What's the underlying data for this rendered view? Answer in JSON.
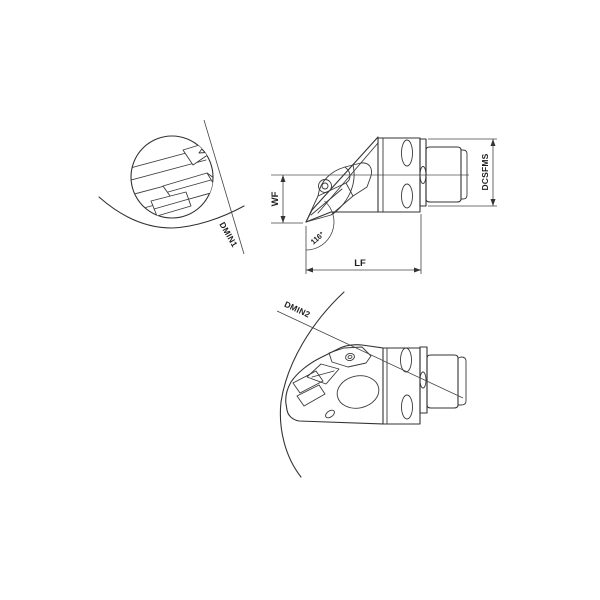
{
  "drawing": {
    "title": "tool-holder-technical-drawing",
    "colors": {
      "background": "#ffffff",
      "line": "#333333",
      "text": "#1f1f1f"
    },
    "views": {
      "detail_top": {
        "dim_label": "DMIN1"
      },
      "side": {
        "labels": {
          "wf": "WF",
          "lf": "LF",
          "dcsfms": "DCSFMS",
          "angle": "116°"
        }
      },
      "iso_bottom": {
        "dim_label": "DMIN2"
      }
    }
  }
}
